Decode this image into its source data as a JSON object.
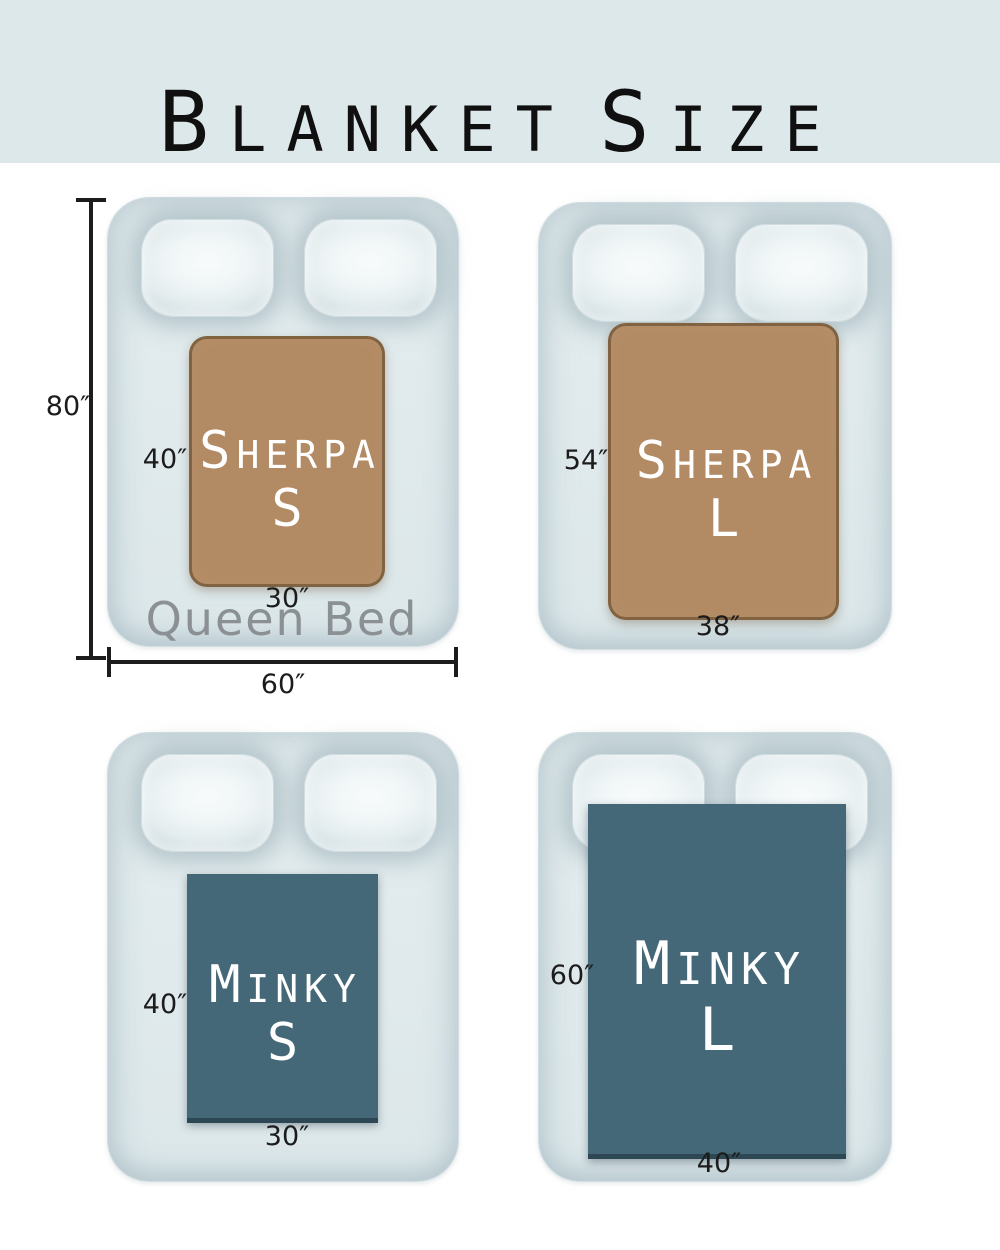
{
  "title": {
    "part1_initial": "B",
    "part1_rest": "LANKET",
    "part2_initial": "S",
    "part2_rest": "IZE"
  },
  "colors": {
    "header_bg": "#dde8ea",
    "bed": "#e0eaec",
    "sherpa": "#b28a63",
    "sherpa_border": "#795c3b",
    "minky": "#456878",
    "minky_edge": "#2d4854",
    "queen_text": "#8a9094",
    "dim_text": "#1c1c1c"
  },
  "panels": {
    "sherpa_s": {
      "name_initial": "S",
      "name_rest": "HERPA",
      "size_letter": "S",
      "height_label": "40″",
      "width_label": "30″",
      "bed": {
        "name": "Queen Bed",
        "height_label": "80″",
        "width_label": "60″"
      }
    },
    "sherpa_l": {
      "name_initial": "S",
      "name_rest": "HERPA",
      "size_letter": "L",
      "height_label": "54″",
      "width_label": "38″"
    },
    "minky_s": {
      "name_initial": "M",
      "name_rest": "INKY",
      "size_letter": "S",
      "height_label": "40″",
      "width_label": "30″"
    },
    "minky_l": {
      "name_initial": "M",
      "name_rest": "INKY",
      "size_letter": "L",
      "height_label": "60″",
      "width_label": "40″"
    }
  }
}
